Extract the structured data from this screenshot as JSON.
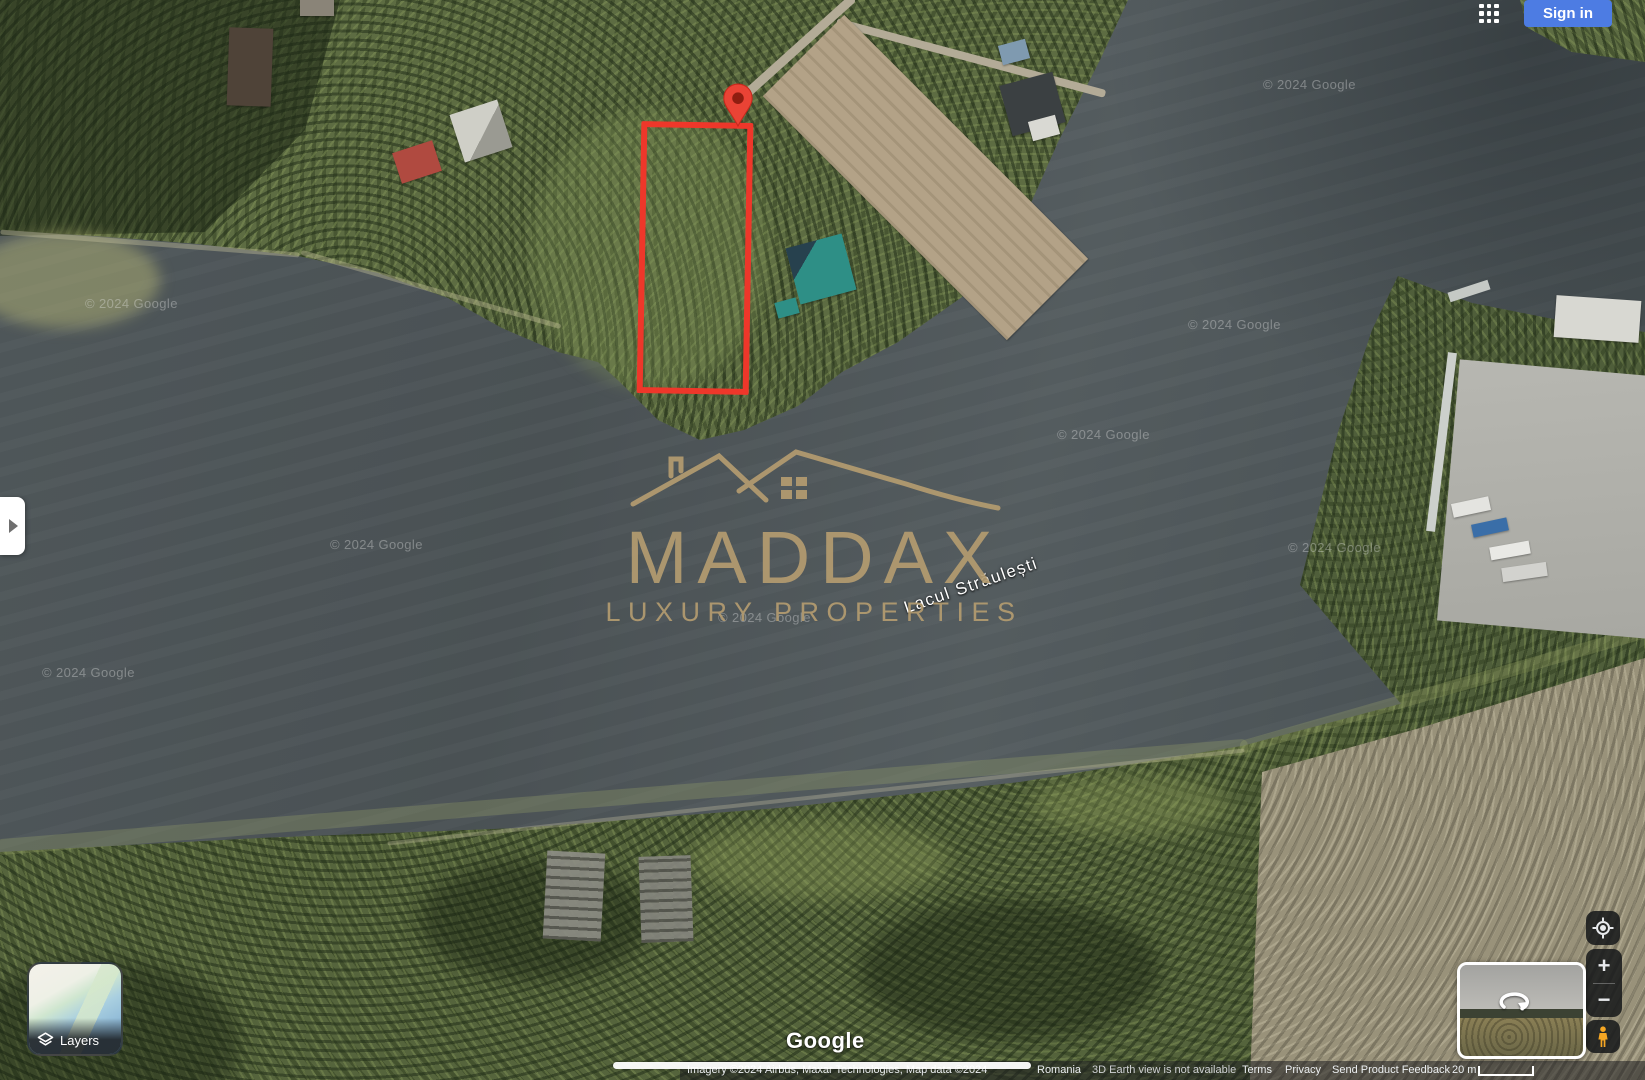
{
  "header": {
    "apps_icon": "google-apps-grid-icon",
    "sign_in": "Sign in"
  },
  "watermark": {
    "brand": "MADDAX",
    "tagline": "LUXURY PROPERTIES"
  },
  "map": {
    "lake_label": "Lacul Străulești",
    "copyright": "© 2024 Google",
    "google_wordmark": "Google"
  },
  "layers": {
    "label": "Layers"
  },
  "zoom": {
    "in": "+",
    "out": "−"
  },
  "attribution": {
    "imagery": "Imagery ©2024 Airbus, Maxar Technologies, Map data ©2024",
    "region": "Romania",
    "notice": "3D Earth view is not available",
    "terms": "Terms",
    "privacy": "Privacy",
    "feedback": "Send Product Feedback",
    "scale": "20 m"
  },
  "colors": {
    "accent_red": "#ee372a",
    "pin_red": "#ea4335",
    "logo_gold": "#b49c70",
    "sign_in_blue": "#4d7ce3"
  }
}
